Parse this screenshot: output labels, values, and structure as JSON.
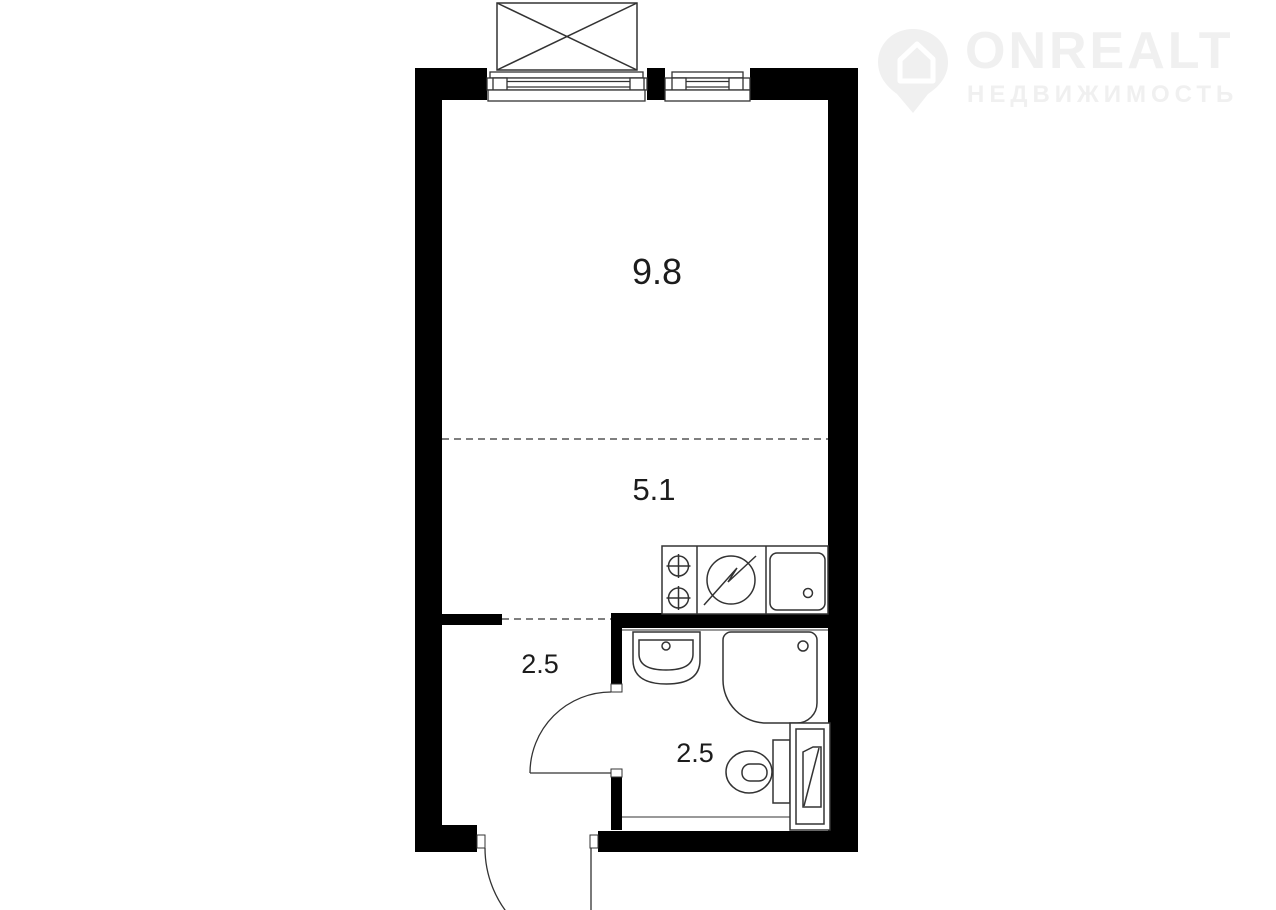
{
  "logo": {
    "brand": "ONREALT",
    "subtitle": "НЕДВИЖИМОСТЬ",
    "color": "#f0f0f0",
    "icon": "house-location-pin-icon"
  },
  "floorplan": {
    "colors": {
      "wall": "#000000",
      "line": "#333333",
      "label": "#1c1c1c",
      "background": "#ffffff"
    },
    "rooms": [
      {
        "name": "living-room",
        "area": "9.8"
      },
      {
        "name": "kitchen-zone",
        "area": "5.1"
      },
      {
        "name": "hallway",
        "area": "2.5"
      },
      {
        "name": "bathroom",
        "area": "2.5"
      }
    ],
    "fixtures": [
      "balcony-box-icon",
      "window-icon",
      "window-icon",
      "stove-burners-icon",
      "kitchen-sink-icon",
      "kitchen-basin-icon",
      "washbasin-icon",
      "shower-tray-icon",
      "toilet-icon",
      "washing-machine-icon",
      "bathroom-door-swing-icon",
      "entrance-door-swing-icon"
    ]
  }
}
